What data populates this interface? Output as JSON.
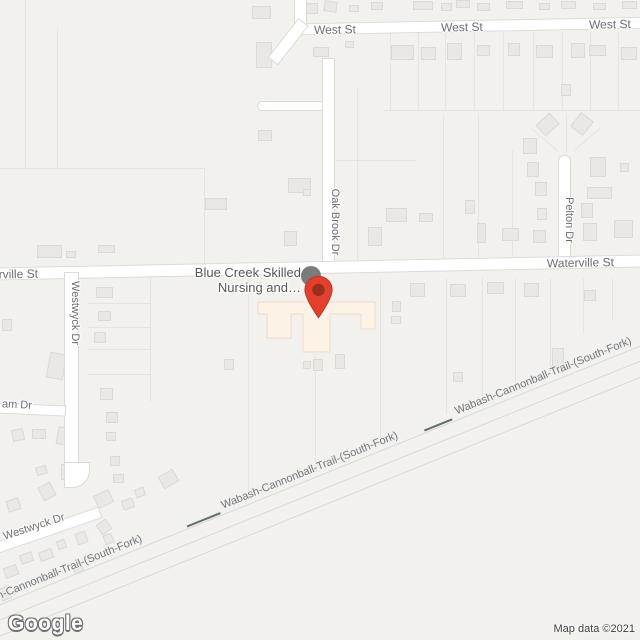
{
  "map": {
    "place_label": {
      "line1": "Blue Creek Skilled",
      "line2": "Nursing and…"
    },
    "street_labels": {
      "west_st": "West St",
      "waterville_st": "Waterville St",
      "oak_brook_dr": "Oak Brook Dr",
      "pelton_dr": "Pelton Dr",
      "westwyck_dr": "Westwyck Dr",
      "am_dr": "am Dr",
      "trail": "Wabash-Cannonball-Trail-(South-Fork)"
    },
    "footer": {
      "logo_text": "Google",
      "attribution": "Map data ©2021"
    },
    "colors": {
      "background": "#f2f1ee",
      "road_fill": "#ffffff",
      "road_casing": "#dcdad6",
      "building_fill": "#e9e8e5",
      "building_stroke": "#dbd9d5",
      "parcel_line": "#e6e4e0",
      "poi_building_fill": "#fcf2e6",
      "poi_building_stroke": "#eedcc6",
      "trail_line": "#5f6f68",
      "street_label": "#6d6d6d",
      "trail_label": "#70757b",
      "place_label": "#565656",
      "pin_red": "#e2402d",
      "pin_dark": "#992f1f",
      "marker_shadow": "#7b7b7b",
      "attribution": "#3c3c3c"
    }
  }
}
